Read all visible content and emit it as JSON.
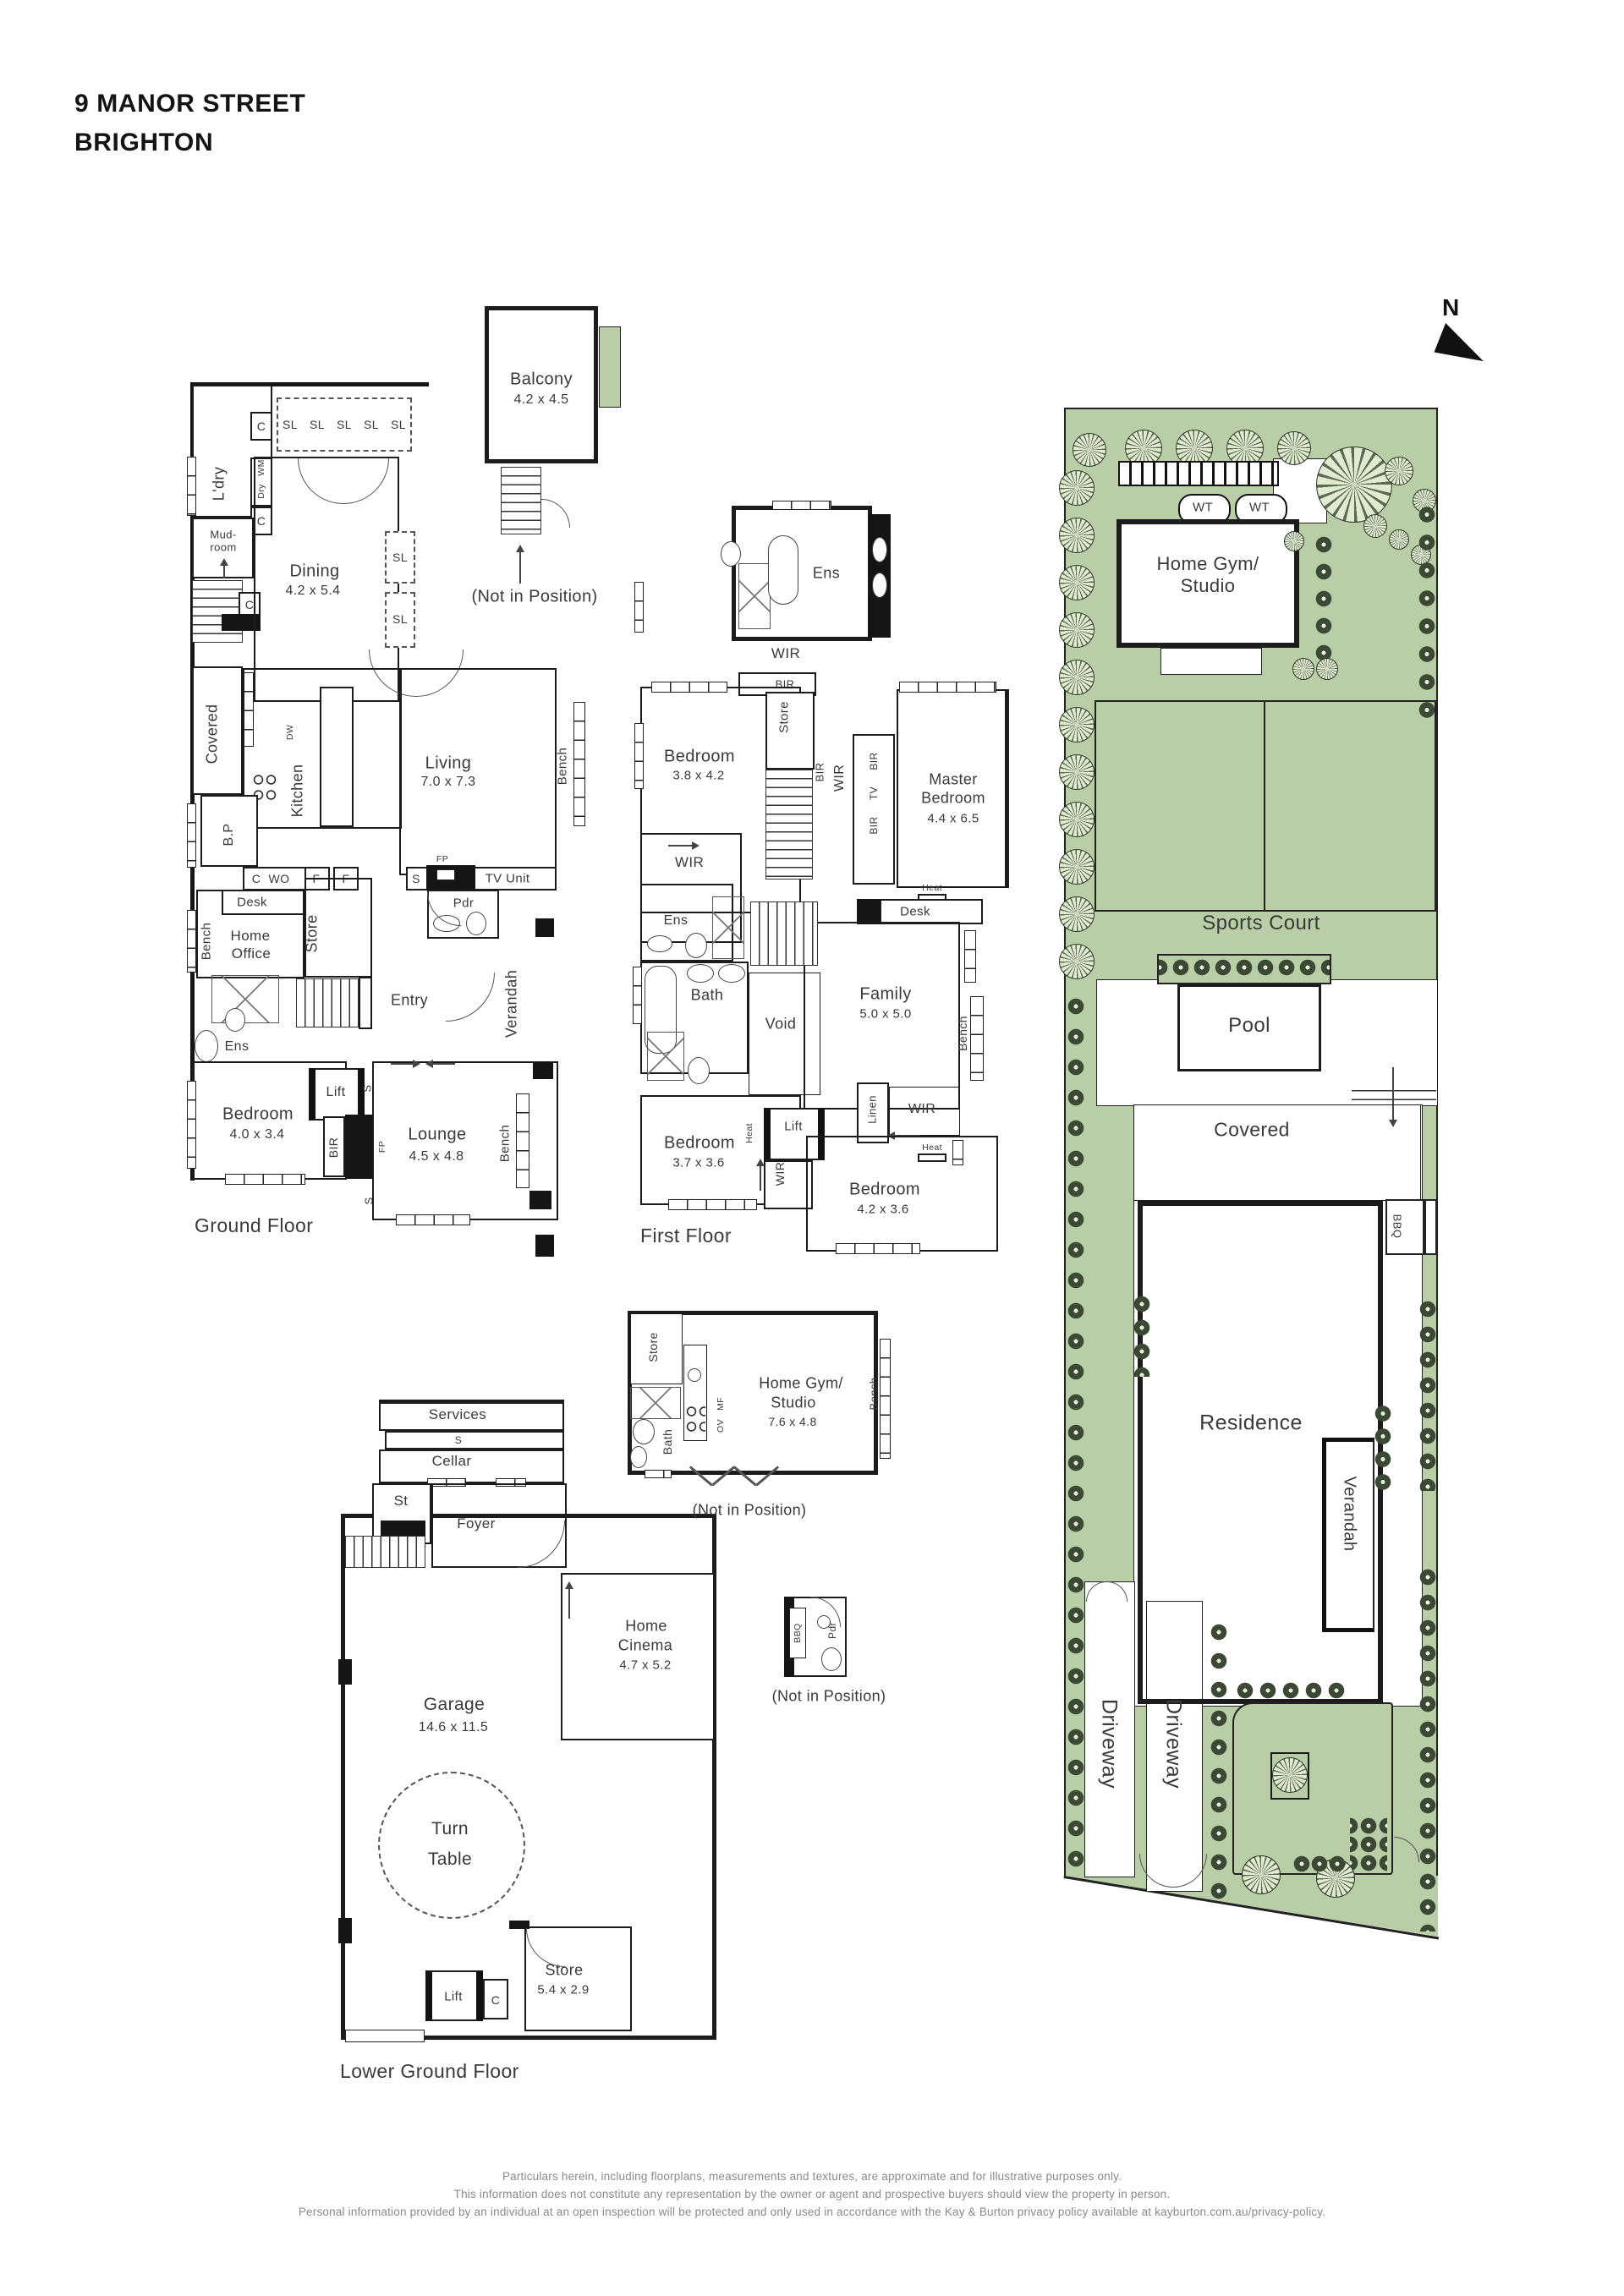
{
  "title": {
    "line1": "9 MANOR STREET",
    "line2": "BRIGHTON"
  },
  "north_label": "N",
  "colors": {
    "site_green": "#b9cda6",
    "hedge_dark": "#3b4934",
    "wall_black": "#1a1a1a",
    "label_gray": "#3a3a3a",
    "footer_gray": "#8a8a8a"
  },
  "common": {
    "bench": "Bench",
    "wir": "WIR",
    "bir": "BIR",
    "ens": "Ens",
    "store": "Store",
    "lift": "Lift",
    "heat": "Heat",
    "desk": "Desk",
    "bath": "Bath",
    "pdr": "Pdr",
    "bbq": "BBQ",
    "sl": "SL",
    "c": "C",
    "s": "S",
    "f": "F",
    "fp": "FP",
    "wm": "WM",
    "dry": "Dry",
    "dw": "DW",
    "wo": "WO",
    "tv": "TV",
    "ov": "OV",
    "mf": "MF",
    "wt": "WT",
    "linen": "Linen",
    "void": "Void",
    "not_in_position": "(Not in Position)"
  },
  "ground": {
    "floor_label": "Ground Floor",
    "balcony": "Balcony",
    "balcony_dims": "4.2 x 4.5",
    "ldry": "L'dry",
    "mudroom_l1": "Mud-",
    "mudroom_l2": "room",
    "dining": "Dining",
    "dining_dims": "4.2 x 5.4",
    "covered": "Covered",
    "kitchen": "Kitchen",
    "bp": "B.P",
    "living": "Living",
    "living_dims": "7.0 x 7.3",
    "home_office_l1": "Home",
    "home_office_l2": "Office",
    "entry": "Entry",
    "verandah": "Verandah",
    "tv_unit": "TV Unit",
    "bedroom": "Bedroom",
    "bedroom_dims": "4.0 x 3.4",
    "lounge": "Lounge",
    "lounge_dims": "4.5 x 4.8"
  },
  "first": {
    "floor_label": "First Floor",
    "bedroom1": "Bedroom",
    "bedroom1_dims": "3.8 x 4.2",
    "master_l1": "Master",
    "master_l2": "Bedroom",
    "master_dims": "4.4 x 6.5",
    "family": "Family",
    "family_dims": "5.0 x 5.0",
    "bedroom2": "Bedroom",
    "bedroom2_dims": "3.7 x 3.6",
    "bedroom3": "Bedroom",
    "bedroom3_dims": "4.2 x 3.6"
  },
  "lower": {
    "floor_label": "Lower Ground Floor",
    "services": "Services",
    "cellar": "Cellar",
    "st": "St",
    "foyer": "Foyer",
    "garage": "Garage",
    "garage_dims": "14.6 x 11.5",
    "turntable_l1": "Turn",
    "turntable_l2": "Table",
    "cinema_l1": "Home",
    "cinema_l2": "Cinema",
    "cinema_dims": "4.7 x 5.2",
    "store_dims": "5.4 x 2.9",
    "gym_l1": "Home Gym/",
    "gym_l2": "Studio",
    "gym_dims": "7.6 x 4.8"
  },
  "site": {
    "gym_l1": "Home Gym/",
    "gym_l2": "Studio",
    "sports_court": "Sports Court",
    "pool": "Pool",
    "covered": "Covered",
    "residence": "Residence",
    "verandah": "Verandah",
    "driveway": "Driveway"
  },
  "footer": {
    "line1": "Particulars herein, including floorplans, measurements and textures, are approximate and for illustrative purposes only.",
    "line2": "This information does not constitute any representation by the owner or agent and prospective buyers should view the property in person.",
    "line3": "Personal information provided by an individual at an open inspection will be protected and only used in accordance with the Kay & Burton privacy policy available at kayburton.com.au/privacy-policy."
  }
}
